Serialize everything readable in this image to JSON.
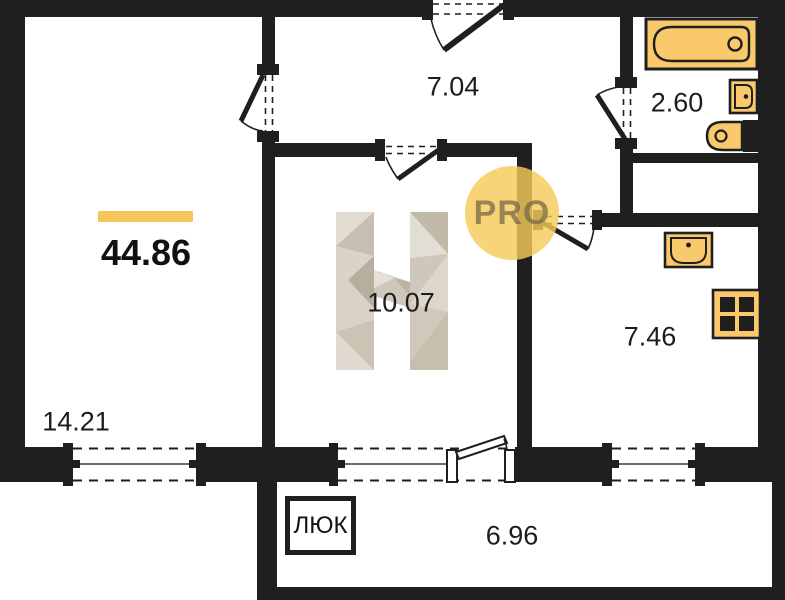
{
  "plan": {
    "type": "apartment-floor-plan",
    "labels": {
      "total_area": "44.86",
      "living_room": "14.21",
      "corridor": "7.04",
      "bathroom": "2.60",
      "bedroom": "10.07",
      "kitchen": "7.46",
      "balcony": "6.96",
      "hatch": "ЛЮК",
      "watermark_badge": "PRO"
    },
    "colors": {
      "wall": "#1F1F1F",
      "accent": "#F7C45A",
      "fixture": "#FAC96B",
      "watermark_beige": "#D8D2C7",
      "badge_circle": "#F6CA5C"
    },
    "icons": [
      "bathtub-icon",
      "washbasin-icon",
      "toilet-icon",
      "kitchen-sink-icon",
      "stove-icon",
      "h-logo-watermark",
      "pro-badge"
    ]
  }
}
